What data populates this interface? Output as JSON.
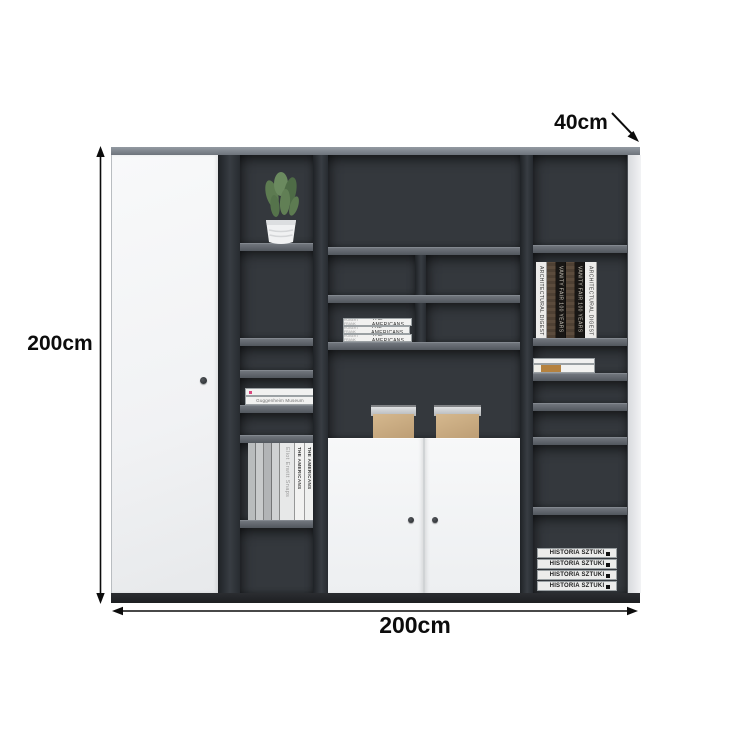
{
  "title": "Bookcase cabinet dimension diagram",
  "dimensions": {
    "height_label": "200cm",
    "width_label": "200cm",
    "depth_label": "40cm"
  },
  "colors": {
    "background": "#ffffff",
    "annotation_black": "#0c0c0c",
    "cabinet_top_band": "#7d838b",
    "interior_dark": "#34383d",
    "shelf_edge_gray": "#5a5f66",
    "divider_dark": "#2a2e33",
    "base_dark": "#212327",
    "door_white": "#f4f5f6",
    "box_tan": "#c9ab83",
    "box_lid_gray": "#c7c9cb",
    "plant_green": "#61804f",
    "book_black": "#1a1816",
    "book_brown": "#4f4134"
  },
  "books": {
    "center_stack": {
      "author": "ROBERT FRANK",
      "titles": [
        "THE AMERICANS",
        "THE AMERICANS",
        "THE AMERICANS"
      ]
    },
    "right_upright": [
      "ARCHITECTURAL DIGEST",
      "VANITY FAIR 100 YEARS",
      "VANITY FAIR 100 YEARS",
      "ARCHITECTURAL DIGEST"
    ],
    "left_flat": [
      "Guggenheim Museum"
    ],
    "left_upright": [
      "Eliot Erwitt Snaps",
      "THE AMERICANS",
      "THE AMERICANS"
    ],
    "bottom_right_stack": [
      "HISTORIA SZTUKI",
      "HISTORIA SZTUKI",
      "HISTORIA SZTUKI",
      "HISTORIA SZTUKI"
    ]
  },
  "items": {
    "plant": "potted succulent plant",
    "boxes": [
      "storage box",
      "storage box"
    ]
  }
}
